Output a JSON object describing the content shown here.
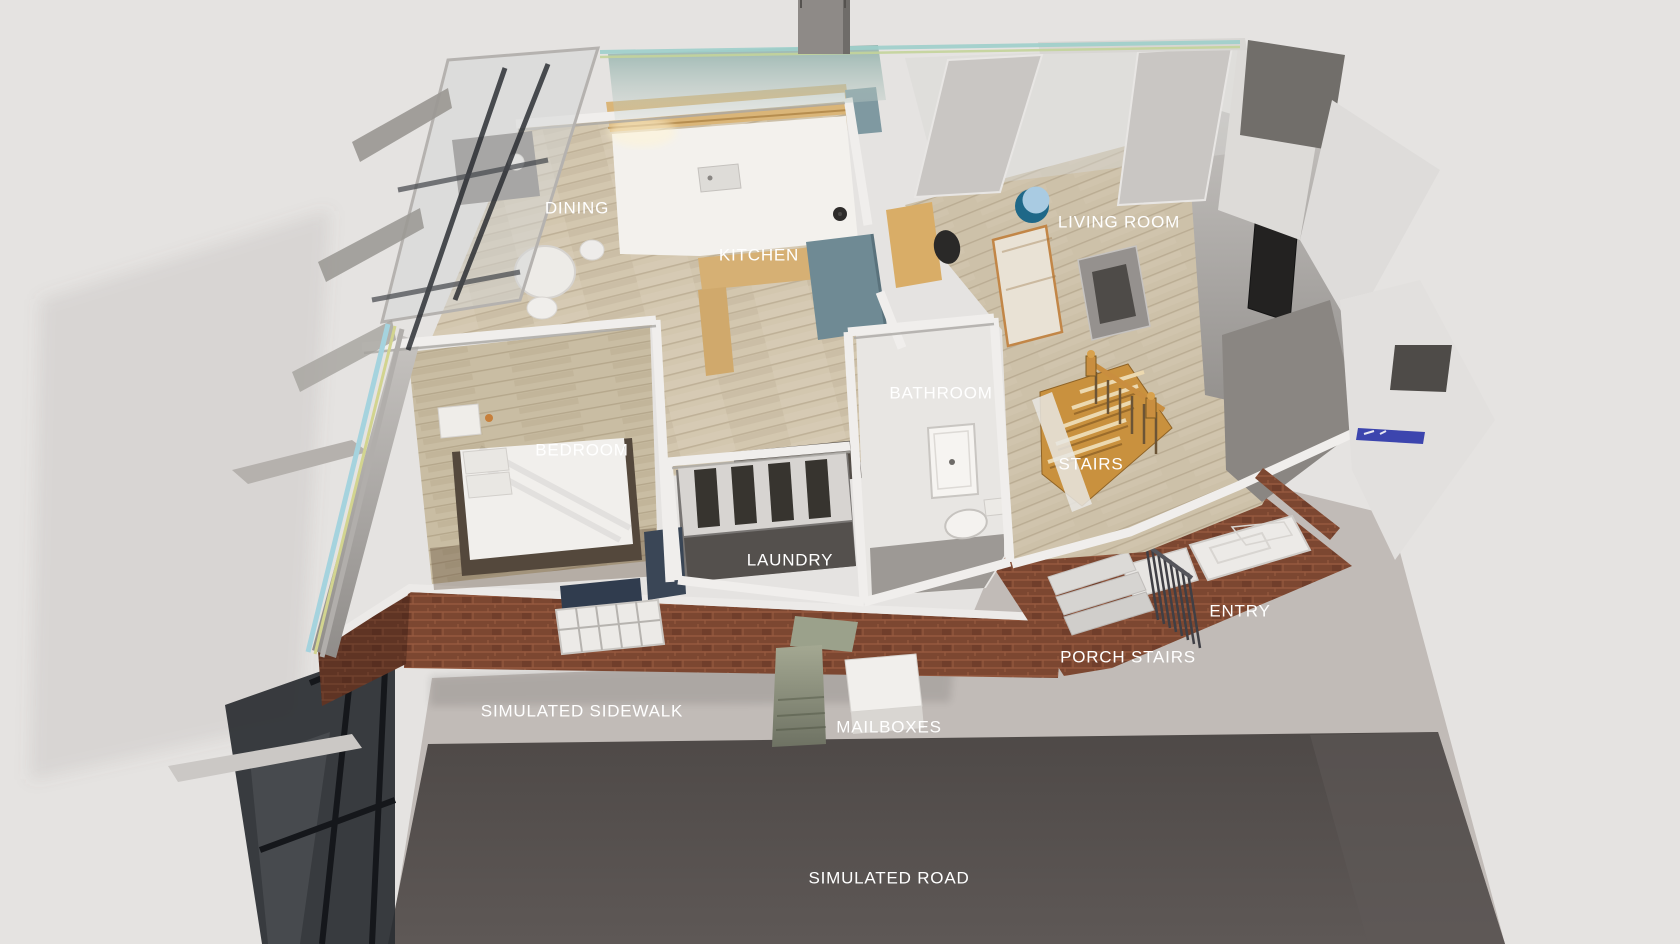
{
  "scene": {
    "description": "Aerial three-quarter view of a simulated single-story apartment cutaway with labeled rooms, sidewalk and road",
    "labels": [
      {
        "id": "dining",
        "text": "DINING",
        "x": 577,
        "y": 208
      },
      {
        "id": "kitchen",
        "text": "KITCHEN",
        "x": 759,
        "y": 255
      },
      {
        "id": "living-room",
        "text": "LIVING ROOM",
        "x": 1119,
        "y": 222
      },
      {
        "id": "bathroom",
        "text": "BATHROOM",
        "x": 941,
        "y": 393
      },
      {
        "id": "bedroom",
        "text": "BEDROOM",
        "x": 582,
        "y": 450
      },
      {
        "id": "stairs",
        "text": "STAIRS",
        "x": 1091,
        "y": 464
      },
      {
        "id": "laundry",
        "text": "LAUNDRY",
        "x": 790,
        "y": 560
      },
      {
        "id": "entry",
        "text": "ENTRY",
        "x": 1240,
        "y": 611
      },
      {
        "id": "porch-stairs",
        "text": "PORCH STAIRS",
        "x": 1128,
        "y": 657
      },
      {
        "id": "simulated-sidewalk",
        "text": "SIMULATED SIDEWALK",
        "x": 582,
        "y": 711
      },
      {
        "id": "mailboxes",
        "text": "MAILBOXES",
        "x": 889,
        "y": 727
      },
      {
        "id": "simulated-road",
        "text": "SIMULATED ROAD",
        "x": 889,
        "y": 878
      }
    ],
    "colors": {
      "background": "#e5e3e1",
      "road": "#565150",
      "sidewalk_concrete": "#c1bbb7",
      "brick": "#7c4731",
      "wood_floor": "#d2c6ae",
      "wall_white": "#f0eeec",
      "kitchen_teal_unit": "#6f8a94",
      "roof_strip_cyan": "#9fd0cb",
      "roof_strip_yellow": "#d2d48f",
      "stair_wood": "#c9913e",
      "logo_blue": "#3c45ae",
      "mailbox_pedestal": "#9aa08c",
      "label_text": "#ffffff"
    }
  }
}
